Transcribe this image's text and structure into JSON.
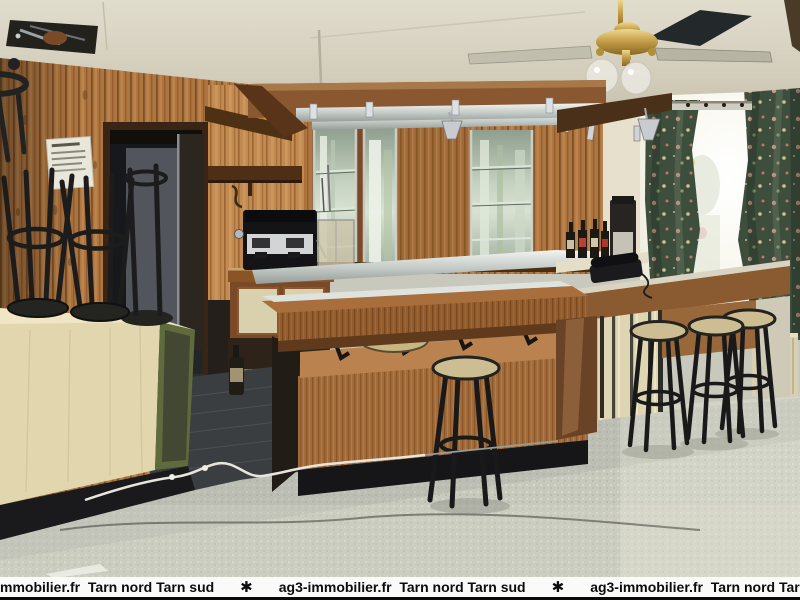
{
  "banner": {
    "segments": [
      "mmobilier.fr  Tarn nord Tarn sud",
      "✱",
      "ag3-immobilier.fr  Tarn nord Tarn sud",
      "✱",
      "ag3-immobilier.fr  Tarn nord Tarn sud"
    ],
    "background": "#fafaf8",
    "text_color": "#0c0c0c"
  },
  "photo": {
    "description": "Empty bar-cafe interior: knotty-pine panelled walls, mirrored back bar with glass shelves, suspended wooden canopy, espresso machine, bar counter with beige-seat stools, upside-down stools stacked on a cream counter, ceiling fan, bright window with dark green floral curtains, speckled tile floor",
    "palette": {
      "ceiling": "#d6d1c0",
      "wood_wall": "#ad7540",
      "bar_wood": "#a26c3a",
      "copper_panel": "#b9824f",
      "cream_counter": "#e2d6ae",
      "cream_slats": "#ded6b2",
      "curtain_green": "#3e4e3d",
      "window_glow": "#f7f6ec",
      "floor_tile": "#c7c9bd",
      "dark_floor": "#3b3e40",
      "stool_seat": "#cdbd92",
      "stool_metal": "#191919",
      "chrome": "#c6ccc8",
      "radiator_cream": "#d8d0ae",
      "kick_black": "#161618"
    }
  }
}
